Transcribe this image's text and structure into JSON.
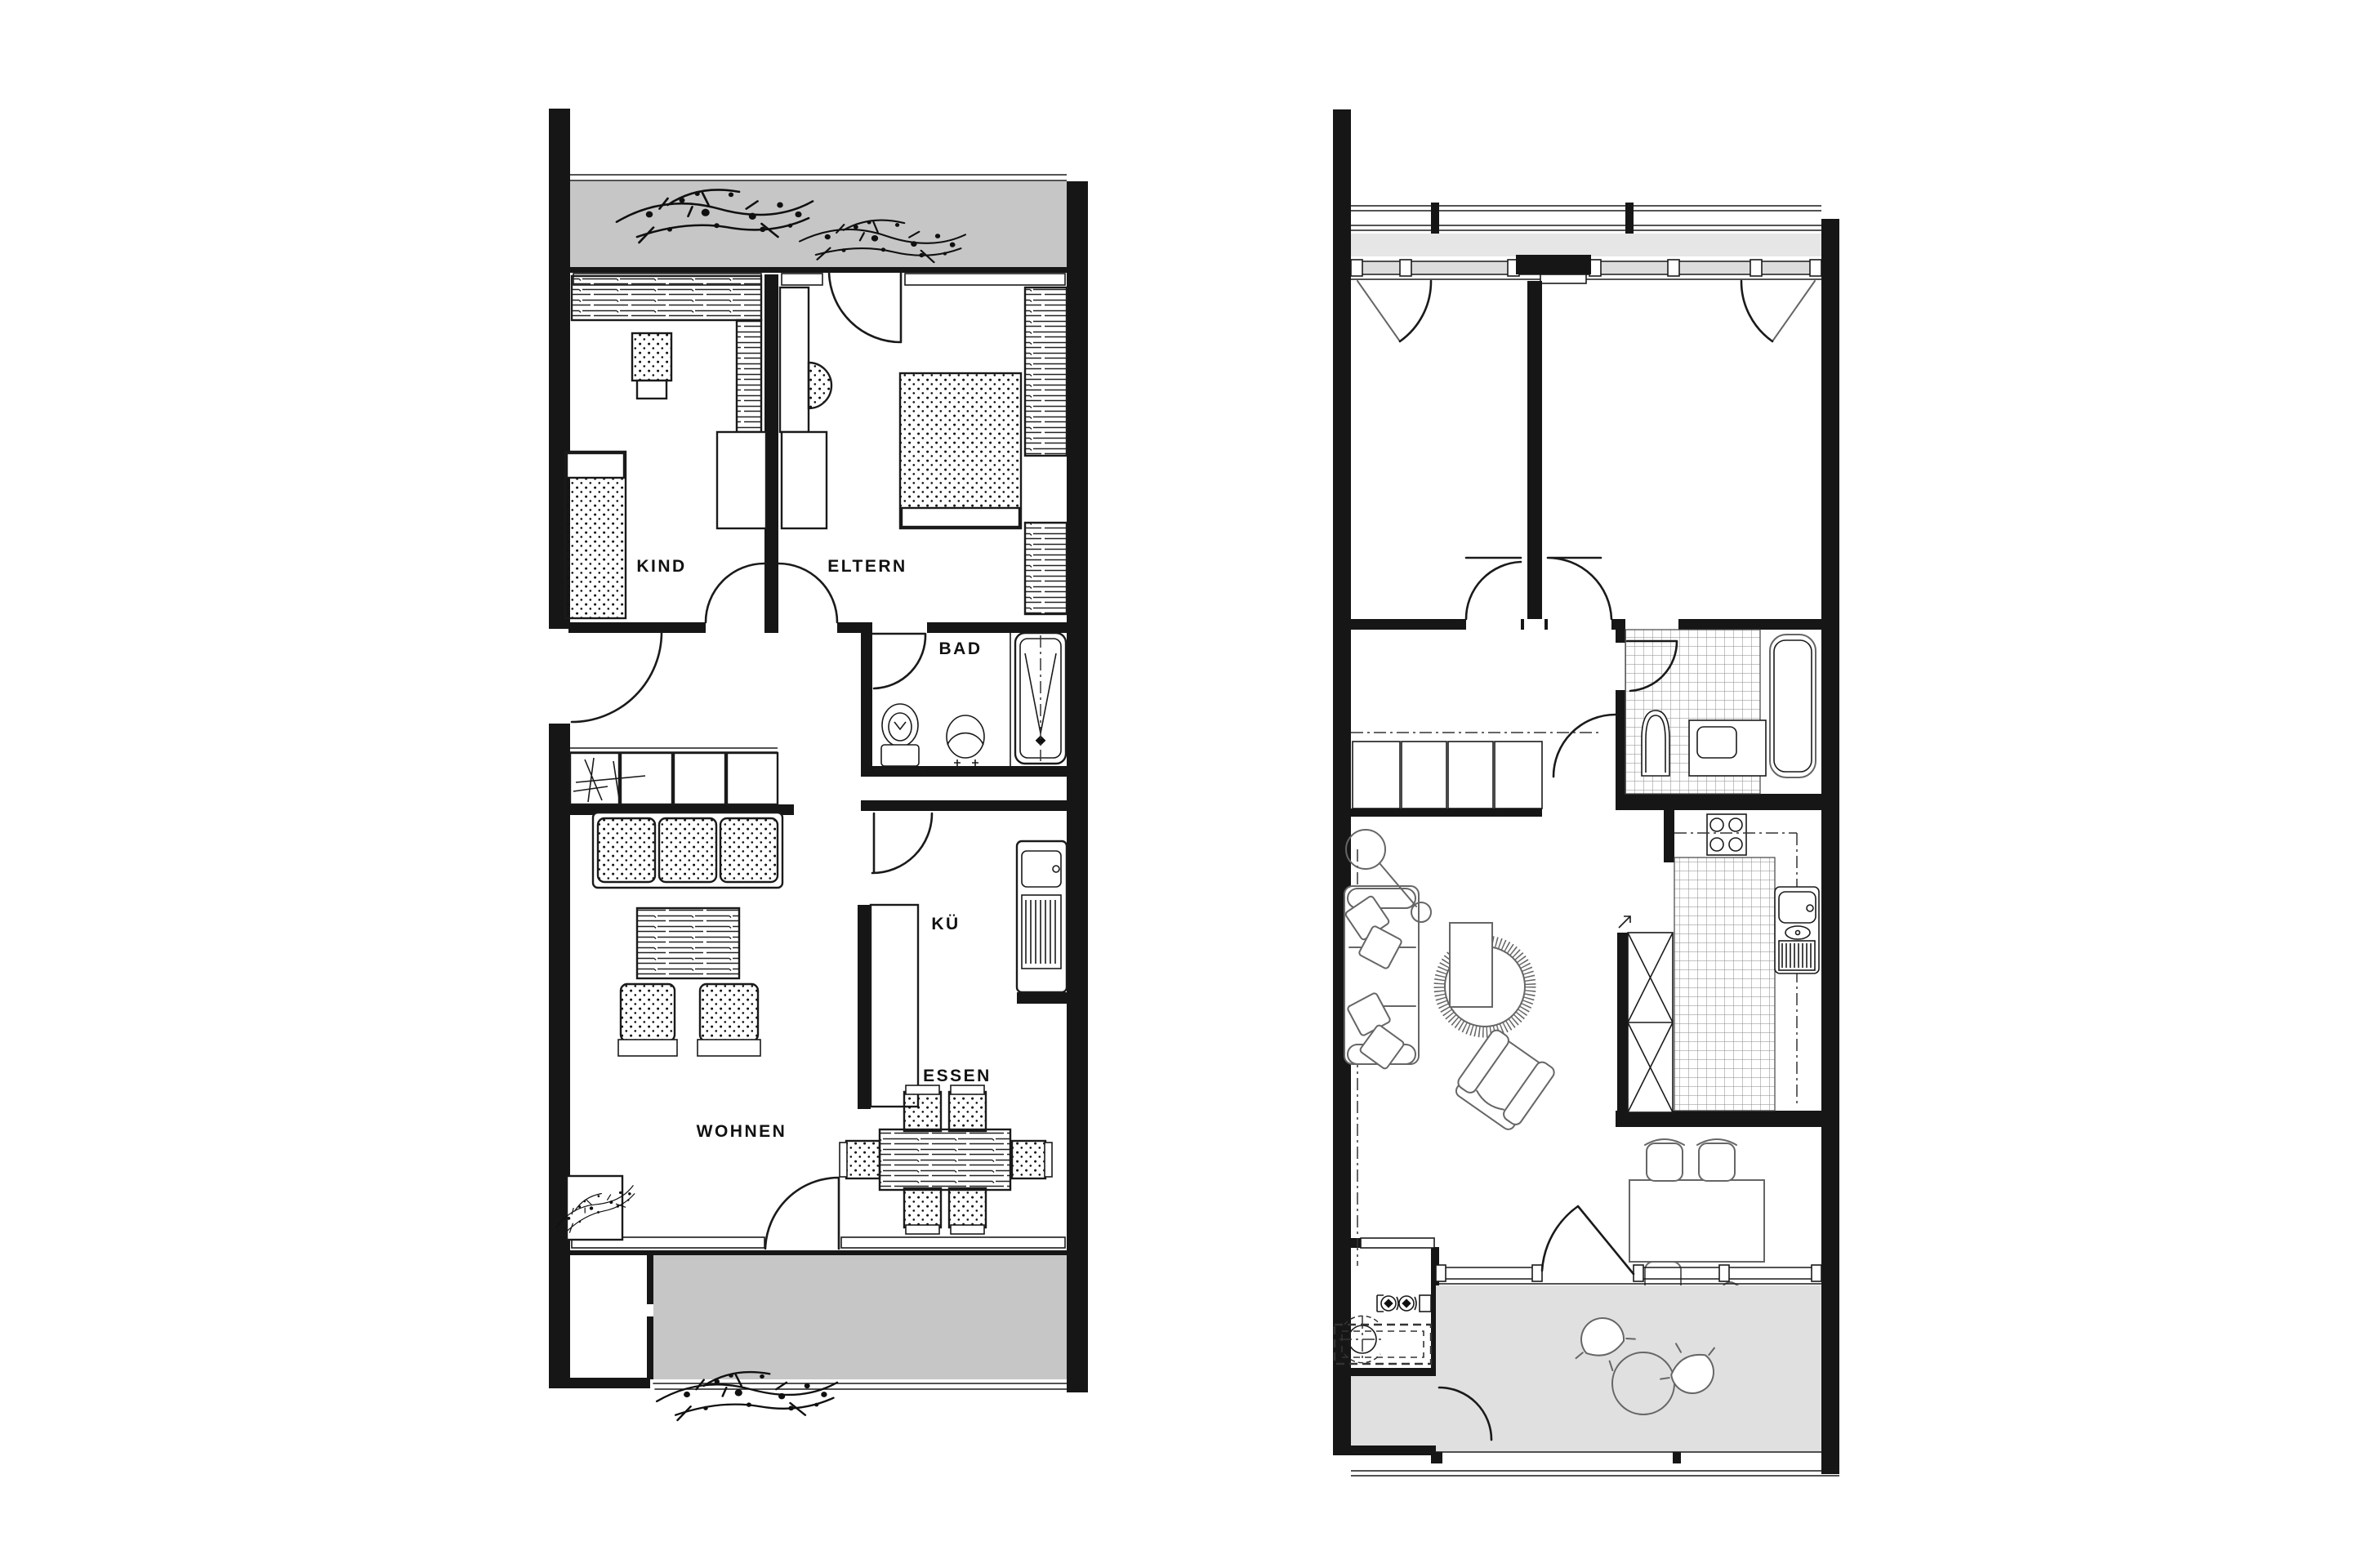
{
  "meta": {
    "type": "architectural-floor-plan-pair",
    "description": "two apartment floor plans side by side, left furnished sketch style, right unfurnished CAD style"
  },
  "colors": {
    "paper": "#ffffff",
    "wall": "#161616",
    "ink": "#1a1a1a",
    "furniture_gray": "#666666",
    "balcony_left": "#c6c6c6",
    "balcony_right": "#e0e0e0",
    "loggia_strip": "#e6e6e6",
    "glazing": "#dcdcdc"
  },
  "plan_left": {
    "name": "furnished plan",
    "labels": {
      "kind": "KIND",
      "eltern": "ELTERN",
      "bad": "BAD",
      "kueche": "KÜ",
      "essen": "ESSEN",
      "wohnen": "WOHNEN"
    }
  },
  "plan_right": {
    "name": "unfurnished plan",
    "labels": {}
  }
}
